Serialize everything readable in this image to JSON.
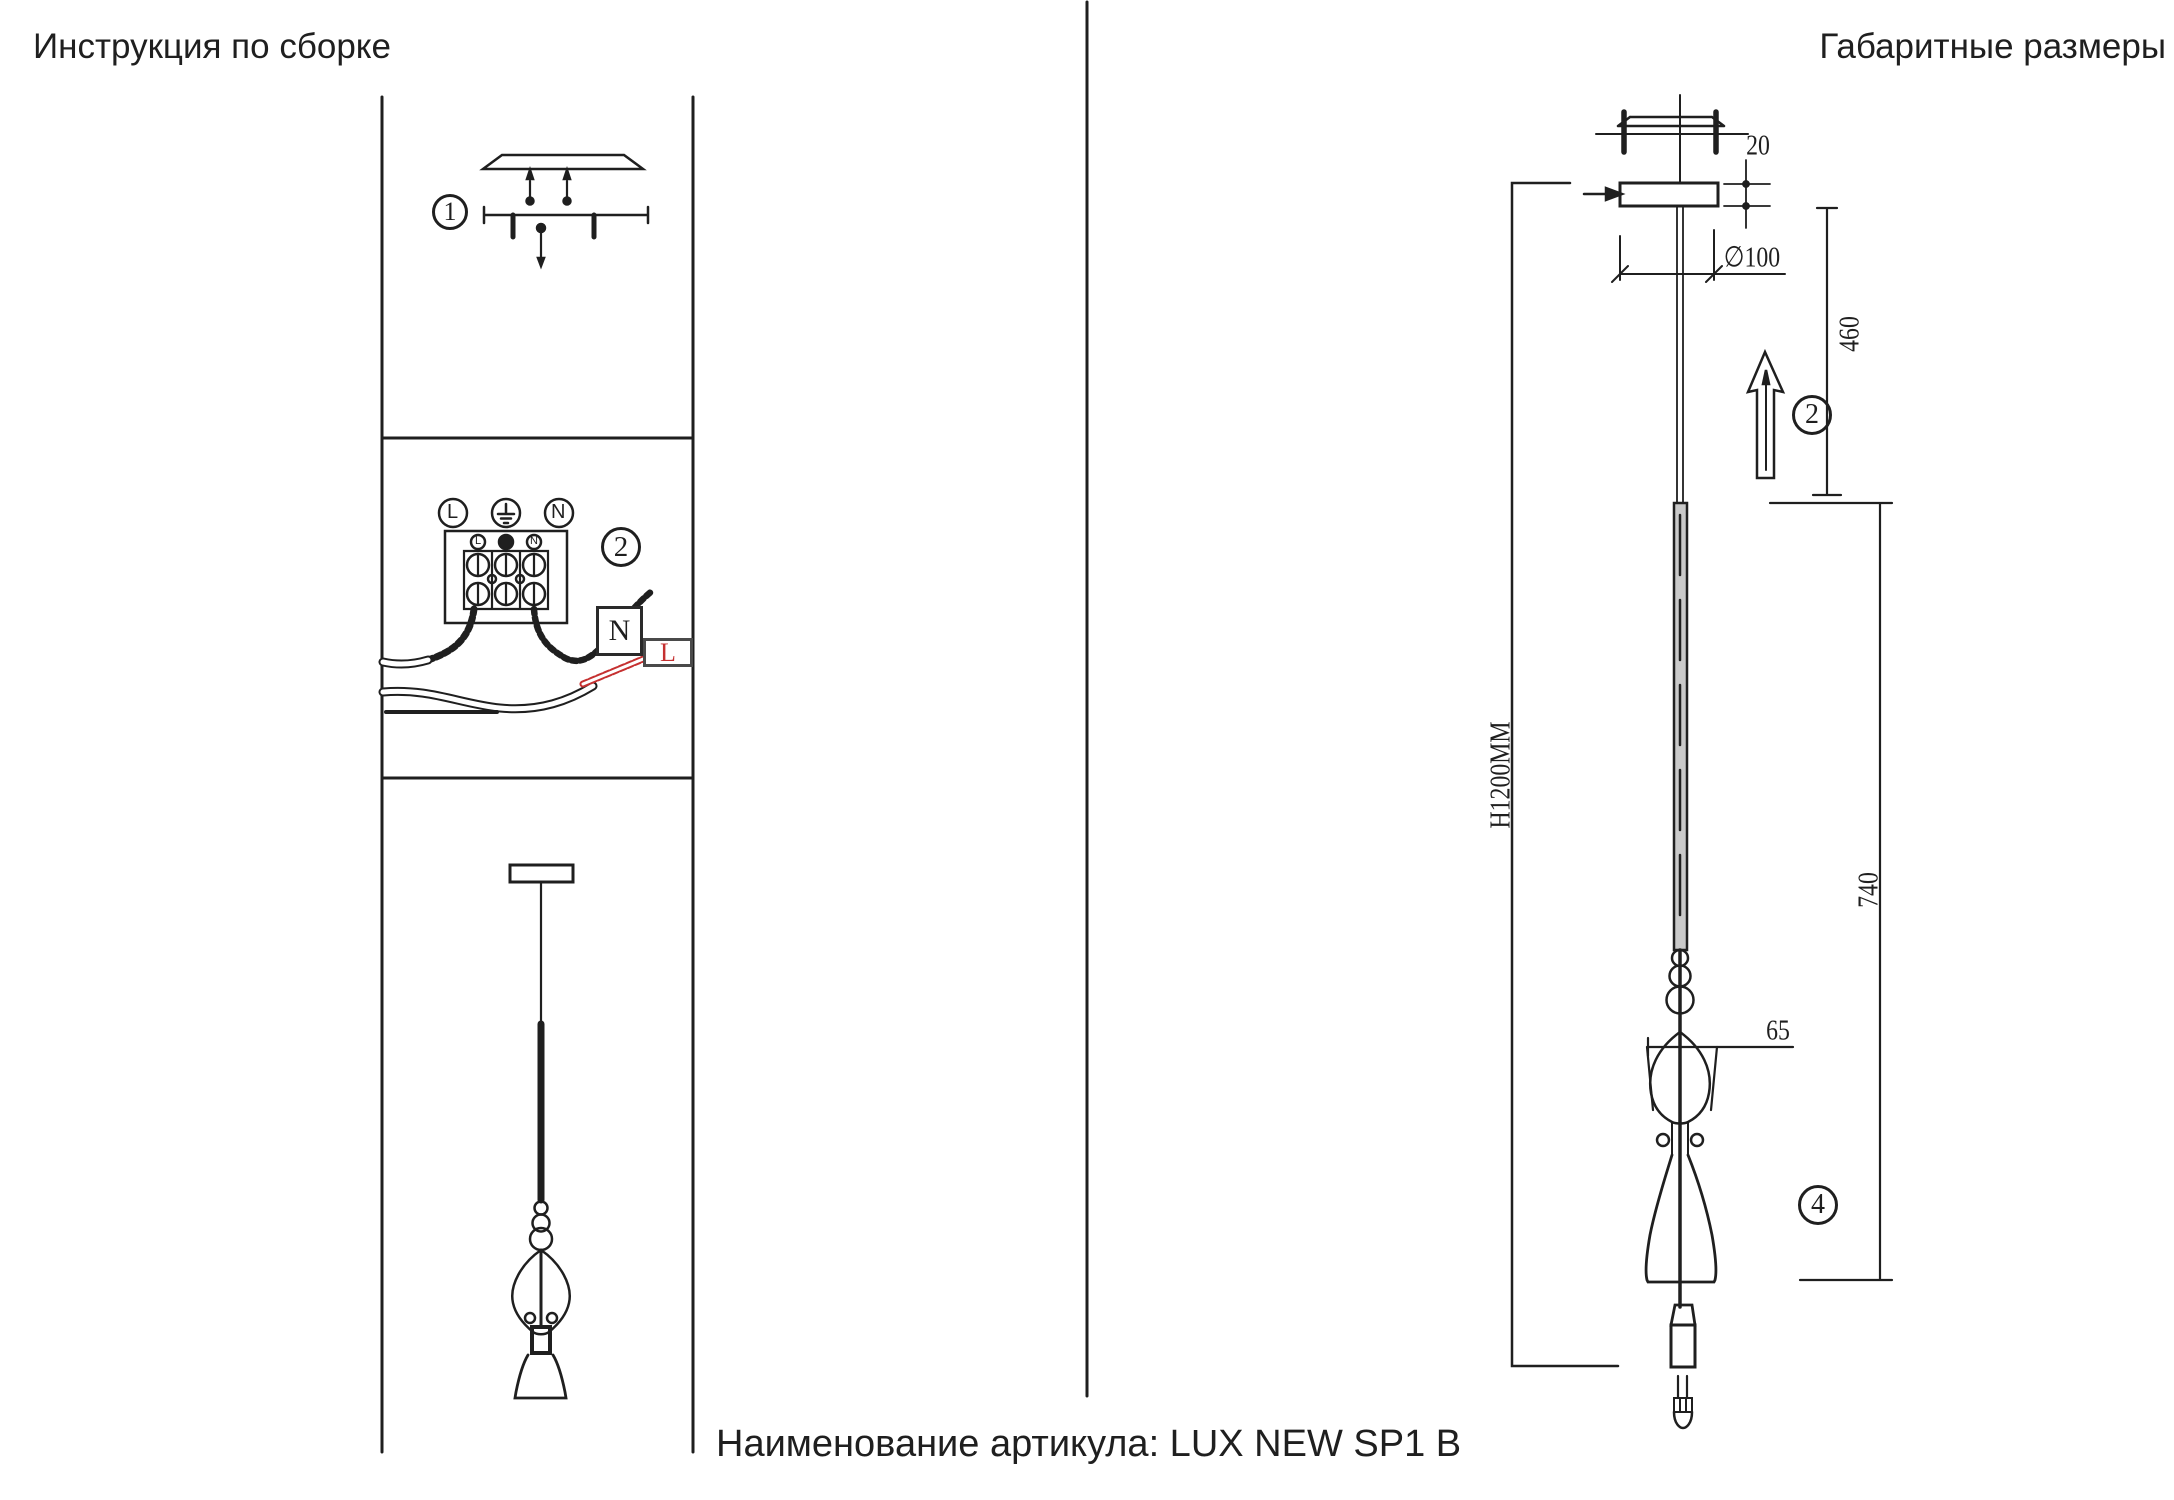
{
  "header": {
    "title_left": "Инструкция по сборке",
    "title_right": "Габаритные размеры"
  },
  "footer": {
    "article_label": "Наименование артикула: LUX NEW SP1 B"
  },
  "assembly": {
    "step1": {
      "callout": "1"
    },
    "step2": {
      "callout": "2",
      "terminals": {
        "line": "L",
        "neutral": "N"
      },
      "terminal_block": {
        "mini_line": "L",
        "mini_neutral": "N"
      },
      "wire_labels": {
        "neutral": "N",
        "line": "L"
      }
    }
  },
  "dimensions": {
    "canopy_thickness": "20",
    "canopy_diameter": "∅100",
    "suspension_height": "460",
    "overall_height": "H1200MM",
    "fixture_height": "740",
    "shade_width": "65",
    "callout_hang": "2",
    "callout_shade": "4"
  },
  "colors": {
    "ink": "#1f1f1f",
    "red": "#c53030",
    "rod_fill": "#c9c9c9"
  }
}
